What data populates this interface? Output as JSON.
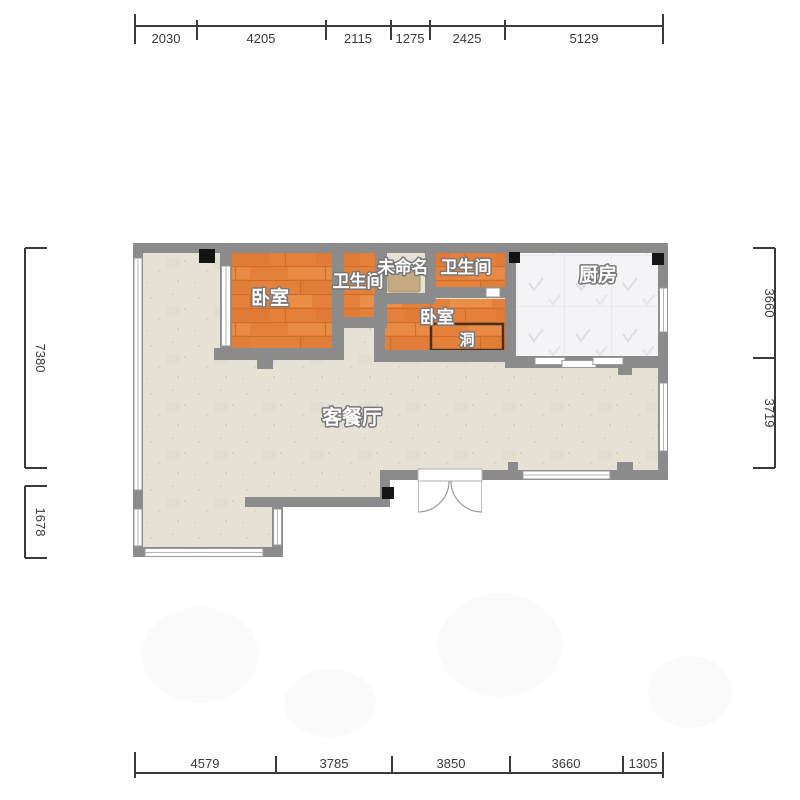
{
  "plan": {
    "rooms": [
      {
        "id": "bedroom-1",
        "label": "卧室"
      },
      {
        "id": "bathroom-1",
        "label": "卫生间"
      },
      {
        "id": "unnamed",
        "label": "未命名"
      },
      {
        "id": "bathroom-2",
        "label": "卫生间"
      },
      {
        "id": "kitchen",
        "label": "厨房"
      },
      {
        "id": "bedroom-2",
        "label": "卧室"
      },
      {
        "id": "hole",
        "label": "洞"
      },
      {
        "id": "living-dining",
        "label": "客餐厅"
      }
    ],
    "dimensions": {
      "top": [
        "2030",
        "4205",
        "2115",
        "1275",
        "2425",
        "5129"
      ],
      "bottom": [
        "4579",
        "3785",
        "3850",
        "3660",
        "1305"
      ],
      "left": [
        "7380",
        "1678"
      ],
      "right": [
        "3660",
        "3719"
      ]
    },
    "colors": {
      "wall": "#8b8b8b",
      "wood_base": "#e5803a",
      "wood_line": "#cc6d28",
      "tile_base": "#e6e1d5",
      "kitchen_base": "#f4f4f6",
      "counter": "#c3aa80",
      "dim_text": "#3a3a3a",
      "column": "#141414",
      "label_text": "#ffffff",
      "hole_border": "#4a3018",
      "window_fill": "#ffffff"
    }
  }
}
